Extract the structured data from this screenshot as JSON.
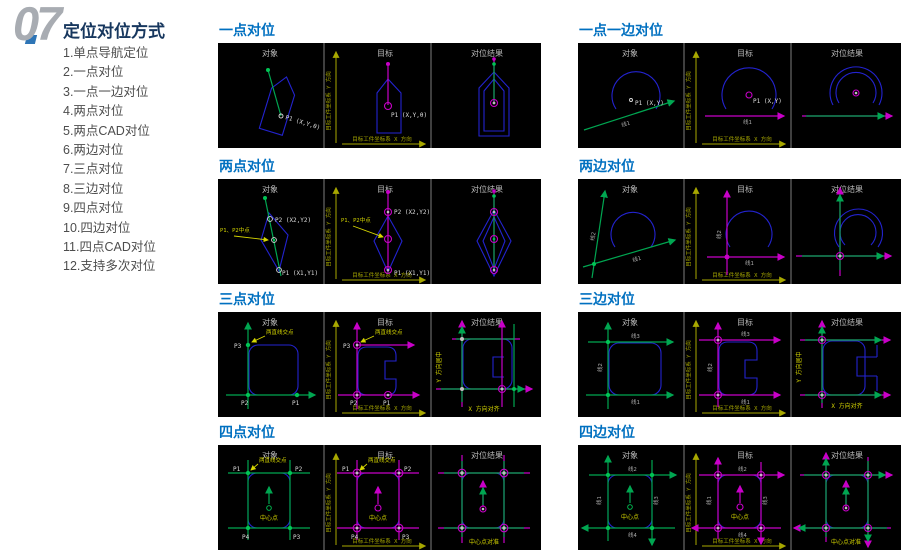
{
  "page": {
    "number": "07",
    "title": "定位对位方式",
    "list": [
      "1.单点导航定位",
      "2.一点对位",
      "3.一点一边对位",
      "4.两点对位",
      "5.两点CAD对位",
      "6.两边对位",
      "7.三点对位",
      "8.三边对位",
      "9.四点对位",
      "10.四边对位",
      "11.四点CAD对位",
      "12.支持多次对位"
    ]
  },
  "labels": {
    "obj": "对象",
    "tgt": "目标",
    "res": "对位结果",
    "axis_x": "目标工件坐标系 X 方向",
    "axis_y": "目标工件坐标系 Y 方向",
    "p1": "P1",
    "p2": "P2",
    "p3": "P3",
    "p4": "P4",
    "p1_xyt": "P1 (X,Y,θ)",
    "p1_xy": "P1 (X,Y)",
    "p1_x1y1": "P1 (X1,Y1)",
    "p2_x2y2": "P2 (X2,Y2)",
    "line1": "线1",
    "line2": "线2",
    "line3": "线3",
    "line4": "线4",
    "midpoint": "P1、P2中点",
    "intersection": "两直线交点",
    "center": "中心点",
    "center_aligned": "中心点对准",
    "x_aligned": "X 方向对齐",
    "y_centered": "Y 方向居中"
  },
  "sections": [
    {
      "title": "一点对位"
    },
    {
      "title": "一点一边对位"
    },
    {
      "title": "两点对位"
    },
    {
      "title": "两边对位"
    },
    {
      "title": "三点对位"
    },
    {
      "title": "三边对位"
    },
    {
      "title": "四点对位"
    },
    {
      "title": "四边对位"
    }
  ],
  "colors": {
    "section_title": "#0070c0",
    "heading": "#17375e",
    "object_green": "#00a651",
    "target_magenta": "#c800c8",
    "shape_blue": "#2323cf",
    "axis_olive": "#a8a800",
    "annotation_yellow": "#d6d600",
    "panel_background": "#000000"
  }
}
